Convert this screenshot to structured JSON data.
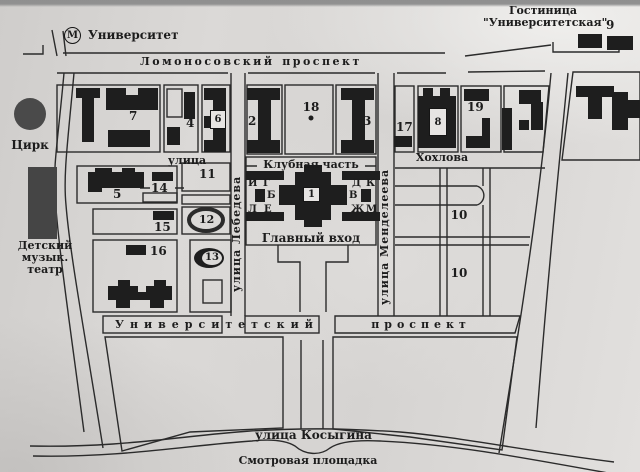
{
  "map": {
    "metro": {
      "symbol": "М",
      "label": "Университет"
    },
    "hotel": {
      "line1": "Гостиница",
      "line2": "\"Университетская\"",
      "number": "9"
    },
    "streets": {
      "lomonosovsky_word1": "Ломоносовский",
      "lomonosovsky_word2": "проспект",
      "ulitsa": "улица",
      "khokhlova": "Хохлова",
      "lebedeva": "улица Лебедева",
      "mendeleeva": "улица Менделеева",
      "universitetsky_word1": "Университетский",
      "universitetsky_word2": "проспект",
      "kosygina": "улица Косыгина",
      "smotrovaya": "Смотровая площадка"
    },
    "landmarks": {
      "circus": "Цирк",
      "theater_line1": "Детский",
      "theater_line2": "музык.",
      "theater_line3": "театр",
      "club_part": "Клубная часть",
      "main_entrance": "Главный вход"
    },
    "wings": {
      "w1": "И",
      "w2": "Г",
      "w3": "Б",
      "w4": "Л",
      "w5": "Е",
      "w6": "Д",
      "w7": "К",
      "w8": "В",
      "w9": "Ж",
      "w10": "М"
    },
    "buildings": {
      "n1": "1",
      "n2": "2",
      "n3": "3",
      "n4": "4",
      "n5": "5",
      "n6": "6",
      "n7": "7",
      "n8": "8",
      "n10a": "10",
      "n10b": "10",
      "n11": "11",
      "n12": "12",
      "n13": "13",
      "n14": "14",
      "n15": "15",
      "n16": "16",
      "n17": "17",
      "n18": "18",
      "n19": "19"
    },
    "colors": {
      "ink": "#1c1c1c",
      "paper": "#d7d5d3",
      "building": "#1e1e1e",
      "gray_building": "#4a4a4a"
    }
  }
}
